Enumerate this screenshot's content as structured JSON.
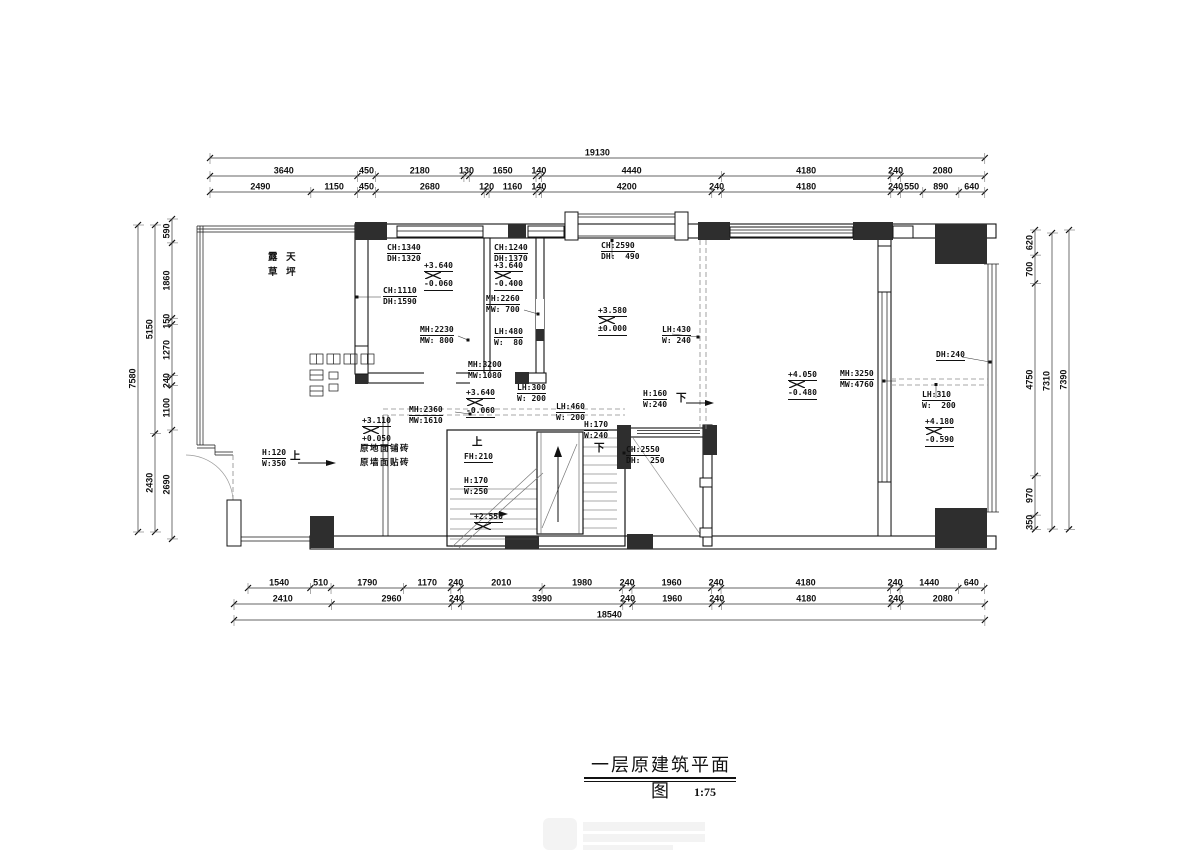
{
  "title": {
    "text": "一层原建筑平面图",
    "scale": "1:75"
  },
  "terrace_label": {
    "line1": "露 天",
    "line2": "草 坪"
  },
  "dims": {
    "top": {
      "overall": "19130",
      "row1": [
        "3640",
        "450",
        "2180",
        "130",
        "1650",
        "140",
        "4440",
        "4180",
        "240",
        "2080"
      ],
      "row2": [
        "2490",
        "1150",
        "450",
        "2680",
        "120",
        "1160",
        "140",
        "4200",
        "240",
        "4180",
        "240",
        "550",
        "890",
        "640"
      ]
    },
    "bottom": {
      "overall": "18540",
      "row1": [
        "1540",
        "510",
        "1790",
        "1170",
        "240",
        "2010",
        "1980",
        "240",
        "1960",
        "240",
        "4180",
        "240",
        "1440",
        "640"
      ],
      "row2": [
        "2410",
        "2960",
        "240",
        "3990",
        "240",
        "1960",
        "240",
        "4180",
        "240",
        "2080"
      ]
    },
    "left": {
      "overall": "7580",
      "mid": [
        "5150",
        "2430"
      ],
      "inner": [
        "590",
        "1860",
        "150",
        "1270",
        "240",
        "1100",
        "2690"
      ]
    },
    "right": {
      "overall": "7390",
      "mid": [
        "7310"
      ],
      "inner": [
        "620",
        "700",
        "4750",
        "970",
        "350"
      ]
    }
  },
  "annotations": [
    {
      "x": 268,
      "y": 250,
      "t": "plain2",
      "cls": "cn",
      "l1": "露 天",
      "l2": "草 坪"
    },
    {
      "x": 387,
      "y": 243,
      "t": "pair",
      "l1": "CH:1340",
      "l2": "DH:1320"
    },
    {
      "x": 494,
      "y": 243,
      "t": "pair",
      "l1": "CH:1240",
      "l2": "DH:1370"
    },
    {
      "x": 601,
      "y": 241,
      "t": "pair",
      "l1": "CH:2590",
      "l2": "DH:  490"
    },
    {
      "x": 424,
      "y": 261,
      "t": "level",
      "l1": "+3.640",
      "l2": "-0.060"
    },
    {
      "x": 494,
      "y": 261,
      "t": "level",
      "l1": "+3.640",
      "l2": "-0.400"
    },
    {
      "x": 383,
      "y": 286,
      "t": "pair",
      "l1": "CH:1110",
      "l2": "DH:1590"
    },
    {
      "x": 486,
      "y": 294,
      "t": "pair",
      "l1": "MH:2260",
      "l2": "MW: 700"
    },
    {
      "x": 598,
      "y": 306,
      "t": "level",
      "l1": "+3.580",
      "l2": "±0.000"
    },
    {
      "x": 420,
      "y": 325,
      "t": "pair",
      "l1": "MH:2230",
      "l2": "MW: 800"
    },
    {
      "x": 494,
      "y": 327,
      "t": "pair",
      "l1": "LH:480",
      "l2": "W:  80"
    },
    {
      "x": 662,
      "y": 325,
      "t": "pair",
      "l1": "LH:430",
      "l2": "W: 240"
    },
    {
      "x": 468,
      "y": 360,
      "t": "pair",
      "l1": "MH:3200",
      "l2": "MW:1080"
    },
    {
      "x": 466,
      "y": 388,
      "t": "level",
      "l1": "+3.640",
      "l2": "-0.060"
    },
    {
      "x": 517,
      "y": 383,
      "t": "pair",
      "l1": "LH:300",
      "l2": "W: 200"
    },
    {
      "x": 556,
      "y": 402,
      "t": "pair",
      "l1": "LH:460",
      "l2": "W: 200"
    },
    {
      "x": 409,
      "y": 405,
      "t": "pair",
      "l1": "MH:2360",
      "l2": "MW:1610"
    },
    {
      "x": 362,
      "y": 416,
      "t": "level",
      "l1": "+3.110",
      "l2": "+0.050"
    },
    {
      "x": 360,
      "y": 441,
      "t": "plain2",
      "cls": "cnsm",
      "l1": "原地面铺砖",
      "l2": "原墙面贴砖"
    },
    {
      "x": 262,
      "y": 448,
      "t": "pair",
      "l1": "H:120",
      "l2": "W:350"
    },
    {
      "x": 290,
      "y": 450,
      "t": "char",
      "cls": "ch",
      "l1": "上"
    },
    {
      "x": 643,
      "y": 389,
      "t": "pair",
      "l1": "H:160",
      "l2": "W:240"
    },
    {
      "x": 676,
      "y": 392,
      "t": "char",
      "cls": "ch",
      "l1": "下"
    },
    {
      "x": 584,
      "y": 420,
      "t": "pair",
      "l1": "H:170",
      "l2": "W:240"
    },
    {
      "x": 594,
      "y": 442,
      "t": "char",
      "cls": "ch",
      "l1": "下"
    },
    {
      "x": 626,
      "y": 445,
      "t": "pair",
      "l1": "CH:2550",
      "l2": "DH:  250"
    },
    {
      "x": 472,
      "y": 436,
      "t": "char",
      "cls": "ch",
      "l1": "上"
    },
    {
      "x": 464,
      "y": 452,
      "t": "single",
      "l1": "FH:210"
    },
    {
      "x": 464,
      "y": 476,
      "t": "pair",
      "l1": "H:170",
      "l2": "W:250"
    },
    {
      "x": 474,
      "y": 512,
      "t": "level",
      "l1": "+2.550"
    },
    {
      "x": 788,
      "y": 370,
      "t": "level",
      "l1": "+4.050",
      "l2": "-0.480"
    },
    {
      "x": 840,
      "y": 369,
      "t": "pair",
      "l1": "MH:3250",
      "l2": "MW:4760"
    },
    {
      "x": 936,
      "y": 350,
      "t": "single",
      "l1": "DH:240"
    },
    {
      "x": 922,
      "y": 390,
      "t": "pair",
      "l1": "LH:310",
      "l2": "W:  200"
    },
    {
      "x": 925,
      "y": 417,
      "t": "level",
      "l1": "+4.180",
      "l2": "-0.590"
    }
  ],
  "watermark": {
    "type": "faint-logo"
  }
}
